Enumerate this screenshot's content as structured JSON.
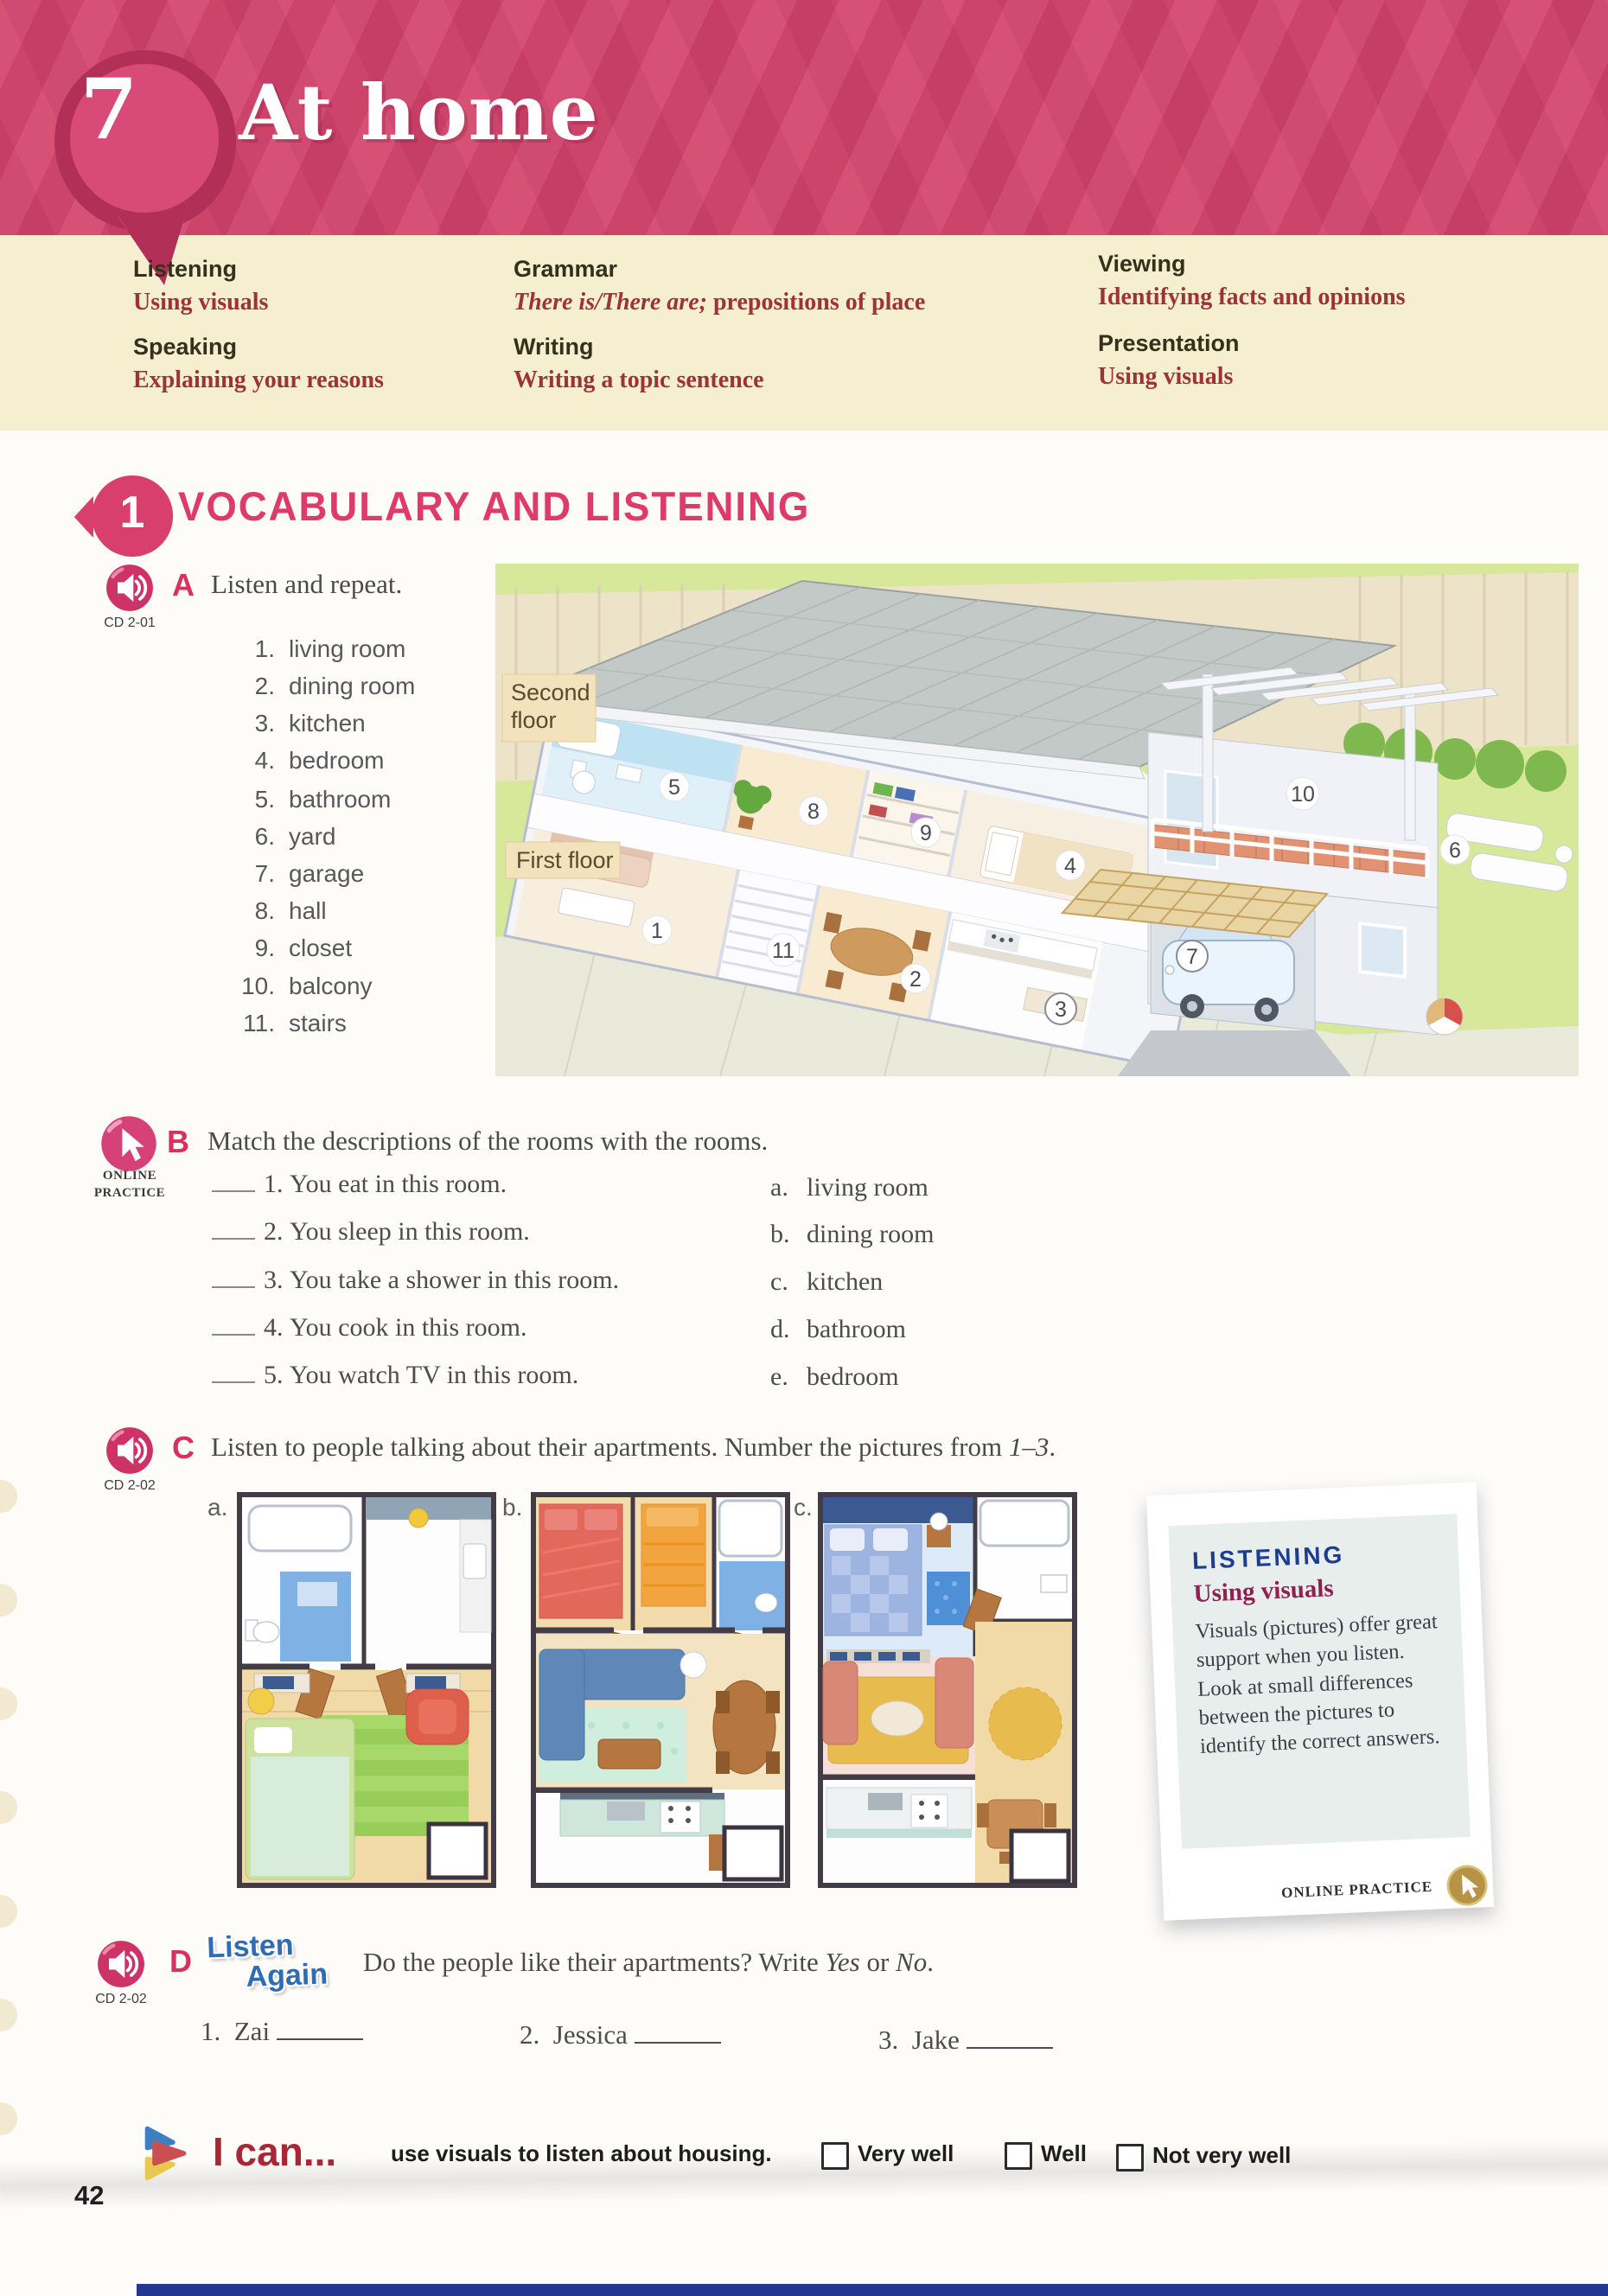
{
  "page": {
    "unit_number": "7",
    "unit_title": "At home",
    "page_number": "42"
  },
  "colors": {
    "header_pink": "#d5476f",
    "cream": "#f6efcf",
    "section_pink": "#de3a6c",
    "skill_value_red": "#9c3338",
    "tip_title_blue": "#1d3e8f",
    "tip_subtitle_maroon": "#8e2150",
    "listen_again_blue": "#2e6cb4",
    "ican_maroon": "#a82737",
    "bottom_strip_blue": "#21388e"
  },
  "skills": [
    {
      "label": "Listening",
      "value_italic": "",
      "value": "Using visuals"
    },
    {
      "label": "Speaking",
      "value_italic": "",
      "value": "Explaining your reasons"
    },
    {
      "label": "Grammar",
      "value_italic": "There is/There are;",
      "value": " prepositions of place"
    },
    {
      "label": "Writing",
      "value_italic": "",
      "value": "Writing a topic sentence"
    },
    {
      "label": "Viewing",
      "value_italic": "",
      "value": "Identifying facts and opinions"
    },
    {
      "label": "Presentation",
      "value_italic": "",
      "value": "Using visuals"
    }
  ],
  "section": {
    "number": "1",
    "title": "VOCABULARY AND LISTENING"
  },
  "exercise_a": {
    "letter": "A",
    "cd": "CD 2-01",
    "instruction": "Listen and repeat.",
    "vocab": [
      {
        "num": "1.",
        "word": "living room"
      },
      {
        "num": "2.",
        "word": "dining room"
      },
      {
        "num": "3.",
        "word": "kitchen"
      },
      {
        "num": "4.",
        "word": "bedroom"
      },
      {
        "num": "5.",
        "word": "bathroom"
      },
      {
        "num": "6.",
        "word": "yard"
      },
      {
        "num": "7.",
        "word": "garage"
      },
      {
        "num": "8.",
        "word": "hall"
      },
      {
        "num": "9.",
        "word": "closet"
      },
      {
        "num": "10.",
        "word": "balcony"
      },
      {
        "num": "11.",
        "word": "stairs"
      }
    ],
    "house": {
      "second_floor_line1": "Second",
      "second_floor_line2": "floor",
      "first_floor_label": "First floor",
      "markers": [
        "1",
        "2",
        "3",
        "4",
        "5",
        "6",
        "7",
        "8",
        "9",
        "10",
        "11"
      ]
    }
  },
  "exercise_b": {
    "letter": "B",
    "badge_line1": "ONLINE",
    "badge_line2": "PRACTICE",
    "instruction": "Match the descriptions of the rooms with the rooms.",
    "items": [
      {
        "num": "1.",
        "text": "You eat in this room."
      },
      {
        "num": "2.",
        "text": "You sleep in this room."
      },
      {
        "num": "3.",
        "text": "You take a shower in this room."
      },
      {
        "num": "4.",
        "text": "You cook in this room."
      },
      {
        "num": "5.",
        "text": "You watch TV in this room."
      }
    ],
    "options": [
      {
        "letter": "a.",
        "text": "living room"
      },
      {
        "letter": "b.",
        "text": "dining room"
      },
      {
        "letter": "c.",
        "text": "kitchen"
      },
      {
        "letter": "d.",
        "text": "bathroom"
      },
      {
        "letter": "e.",
        "text": "bedroom"
      }
    ]
  },
  "exercise_c": {
    "letter": "C",
    "cd": "CD 2-02",
    "instruction_prefix": "Listen to people talking about their apartments. Number the pictures from ",
    "instruction_range": "1–3",
    "instruction_suffix": ".",
    "pictures": [
      {
        "label": "a."
      },
      {
        "label": "b."
      },
      {
        "label": "c."
      }
    ]
  },
  "tip_box": {
    "title": "LISTENING",
    "subtitle": "Using visuals",
    "body": "Visuals (pictures) offer great support when you listen. Look at small differences between the pictures to identify the correct answers.",
    "footer": "ONLINE PRACTICE"
  },
  "exercise_d": {
    "letter": "D",
    "cd": "CD 2-02",
    "listen_again_line1": "Listen",
    "listen_again_line2": "Again",
    "instruction_prefix": "Do the people like their apartments? Write ",
    "instruction_yes": "Yes",
    "instruction_or": " or ",
    "instruction_no": "No",
    "instruction_period": ".",
    "items": [
      {
        "num": "1.",
        "name": "Zai"
      },
      {
        "num": "2.",
        "name": "Jessica"
      },
      {
        "num": "3.",
        "name": "Jake"
      }
    ]
  },
  "i_can": {
    "label": "I can...",
    "statement": "use visuals to listen about housing.",
    "options": [
      "Very well",
      "Well",
      "Not very well"
    ]
  }
}
